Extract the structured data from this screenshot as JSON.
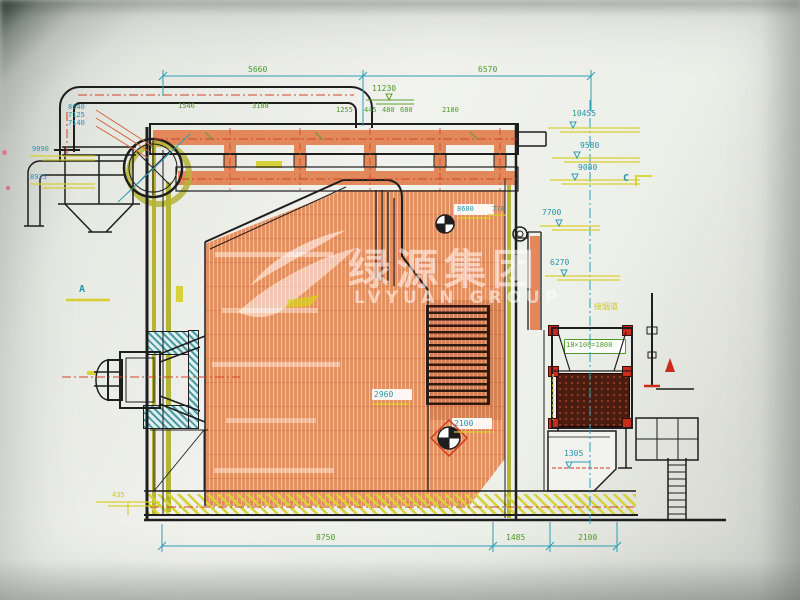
{
  "watermark": {
    "cn": "绿源集团",
    "en": "LVYUAN GROUP"
  },
  "top_dims": {
    "span_left": "5660",
    "span_right": "6570",
    "total_level": "11230",
    "row": [
      "1546",
      "3188",
      "1255",
      "445",
      "480",
      "680",
      "2180"
    ]
  },
  "left_levels": {
    "stack": [
      "8640",
      "7125",
      "7140"
    ],
    "lv1": "9090",
    "lv2": "8925",
    "lv_base": "435"
  },
  "right_levels": {
    "lv1": "10455",
    "lv2": "9580",
    "lv3": "9080",
    "lv4": "7700",
    "lv5": "6270"
  },
  "inner_labels": {
    "lbl_8600": "8600",
    "lbl_770": "770",
    "lbl_2960": "2960",
    "lbl_2100": "2100",
    "lbl_1305": "1305",
    "tube_note": "18×100=1800",
    "flue_note": "接烟道"
  },
  "bottom_dims": {
    "d1": "8750",
    "d2": "1485",
    "d3": "2100"
  },
  "sections": {
    "a": "A",
    "c": "C"
  }
}
